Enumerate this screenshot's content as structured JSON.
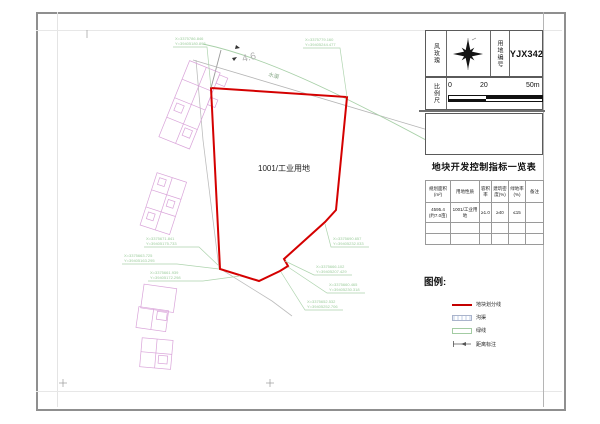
{
  "sheet": {
    "windrose_label": "风玫瑰",
    "plot_no_label": "用地编号",
    "plot_no": "YJX342",
    "scale_label": "比例尺",
    "scale_ticks": [
      "0",
      "20",
      "50m"
    ]
  },
  "table": {
    "title": "地块开发控制指标一览表",
    "headers": [
      "规划面积(m²)",
      "用地性质",
      "容积率",
      "建筑密度(%)",
      "绿地率(%)",
      "备注"
    ],
    "row1": {
      "area": "4595.4",
      "area_note": "(约7.0亩)",
      "use": "1001/工业用地",
      "far": "≥1.0",
      "density": "≥40",
      "green": "≤15",
      "remark": ""
    }
  },
  "legend": {
    "title": "图例:",
    "items": [
      {
        "label": "地块划分线",
        "swatch": "red-line"
      },
      {
        "label": "沟渠",
        "swatch": "hatched-box"
      },
      {
        "label": "绿线",
        "swatch": "green-box"
      },
      {
        "label": "距离标注",
        "swatch": "distance-arrow"
      }
    ]
  },
  "map": {
    "parcel_label": "1001/工业用地",
    "channel_label": "水渠",
    "dim_label": "4.6",
    "colors": {
      "parcel_line": "#d40000",
      "building_line": "#d9a3d9",
      "annotation_green": "#9ccc9c",
      "survey_gray": "#b3b3b3"
    },
    "coord_labels": [
      {
        "x": "X=3375786.846",
        "y": "Y=39405180.893"
      },
      {
        "x": "X=3375779.160",
        "y": "Y=39405244.477"
      },
      {
        "x": "X=3375671.841",
        "y": "Y=39405175.733"
      },
      {
        "x": "X=3375663.725",
        "y": "Y=39405163.295"
      },
      {
        "x": "X=3375661.939",
        "y": "Y=39405172.298"
      },
      {
        "x": "X=3375690.657",
        "y": "Y=39405232.033"
      },
      {
        "x": "X=3375666.102",
        "y": "Y=39405207.429"
      },
      {
        "x": "X=3375660.465",
        "y": "Y=39405230.318"
      },
      {
        "x": "X=3375652.532",
        "y": "Y=39405252.706"
      }
    ]
  }
}
